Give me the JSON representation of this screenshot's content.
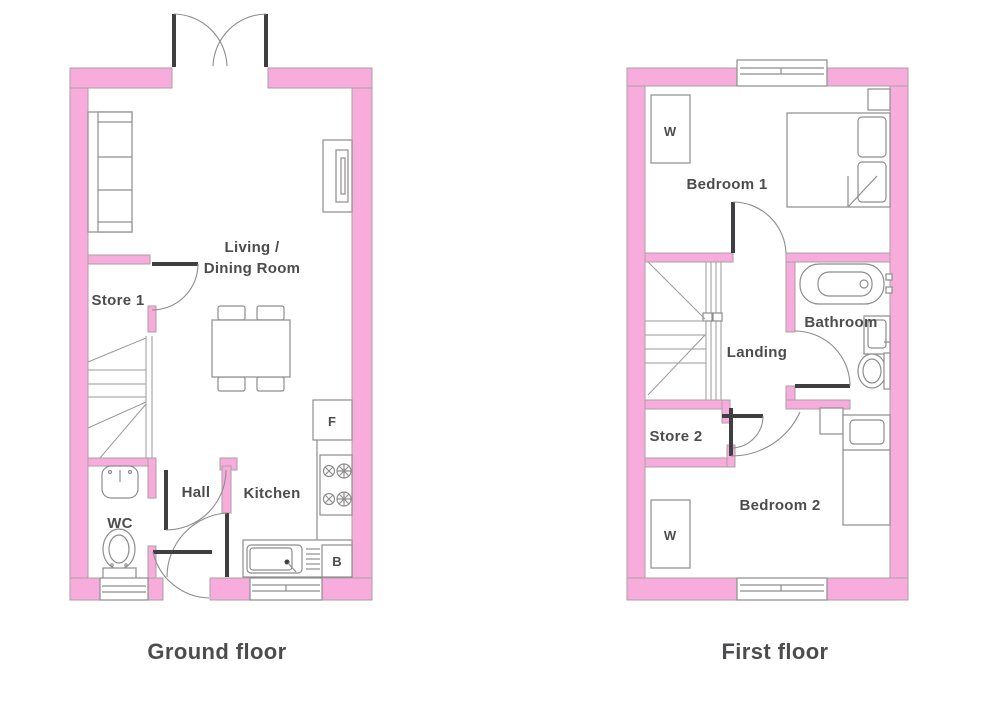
{
  "colors": {
    "wall_pink": "#F7ACDC",
    "outline_gray": "#A8A0A6",
    "fixture_gray": "#8D8D8D",
    "door_dark": "#3F3F41",
    "text_gray": "#4C4C4E"
  },
  "ground_floor": {
    "title": "Ground floor",
    "rooms": {
      "living_line1": "Living /",
      "living_line2": "Dining Room",
      "store": "Store 1",
      "hall": "Hall",
      "kitchen": "Kitchen",
      "wc": "WC"
    },
    "appliances": {
      "fridge": "F",
      "boiler": "B"
    }
  },
  "first_floor": {
    "title": "First floor",
    "rooms": {
      "bedroom1": "Bedroom 1",
      "bathroom": "Bathroom",
      "landing": "Landing",
      "store": "Store 2",
      "bedroom2": "Bedroom 2"
    },
    "furniture": {
      "wardrobe": "W"
    }
  }
}
